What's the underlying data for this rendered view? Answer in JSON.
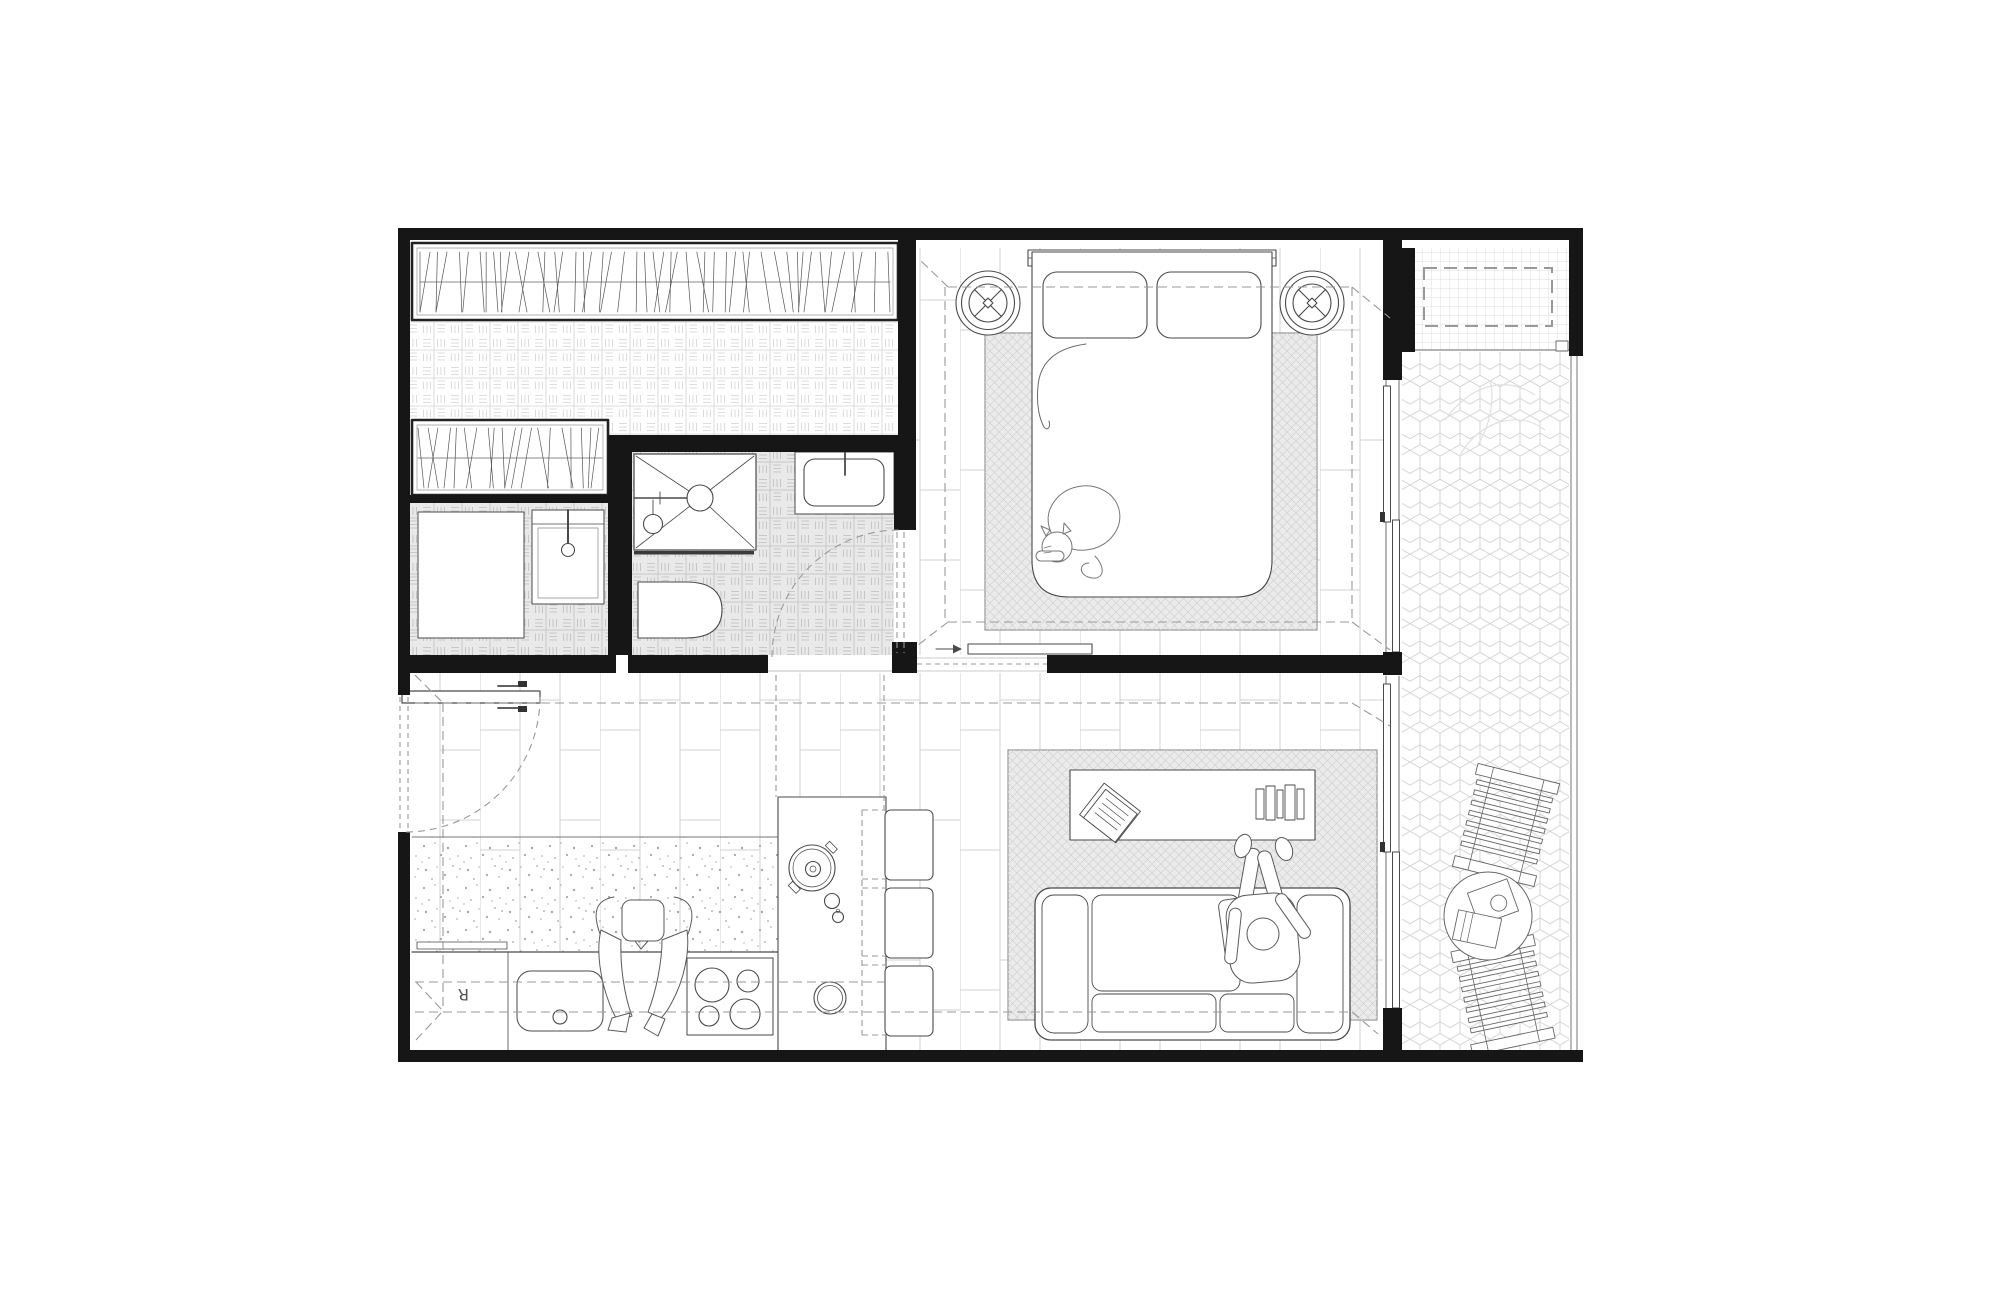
{
  "plan": {
    "fridge_label": "R"
  },
  "colors": {
    "bg": "#ffffff",
    "wall": "#161616",
    "line": "#4a4a4a",
    "dash": "#999999",
    "pattern": "#d2d2d2",
    "pattern_dark": "#bdbdbd",
    "speck": "#a6a6a6",
    "floor_fill": "#e9e9e9",
    "rug_fill": "#ebebeb"
  }
}
